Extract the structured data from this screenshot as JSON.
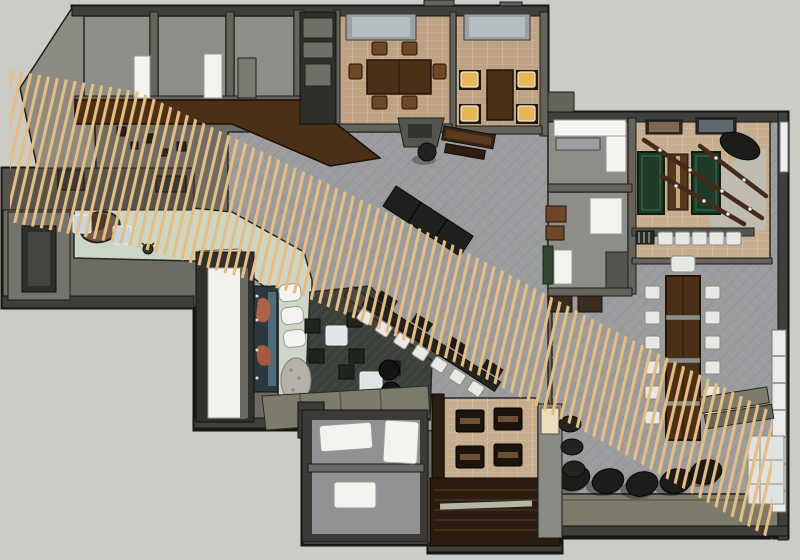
{
  "scene": {
    "type": "architectural-3d-floor-plan-render",
    "style": "sketchup-overhead-view",
    "subject": "restaurant-bar interior plan with diagonal wood slat screen"
  },
  "palette": {
    "canvas": "#cbccc6",
    "wall_face": "#6c6b64",
    "wall_dark": "#403f3b",
    "facade_gray": "#8b8a83",
    "floor_tile": "#9b9c9e",
    "floor_brick": "#bfa284",
    "floor_brick_light": "#c7ad8e",
    "floor_mint": "#ccd6c5",
    "floor_lounge": "#3b403a",
    "floor_white": "#f1f1ed",
    "floor_room": "#8e8e88",
    "floor_restroom": "#909193",
    "slat": "#e9bd7f",
    "wood_dark": "#4b3018",
    "wood_mid": "#6e4826",
    "wood_stair": "#2a1c0f",
    "pool_green": "#1e3b28",
    "seat_amber": "#e8b557",
    "seat_white": "#e8e8e4",
    "cube": "#20261f",
    "white_fixture": "#f3f3ef",
    "black": "#1c1c1a",
    "olive": "#7d7c6b",
    "skylight": "#b6bdc1",
    "lightblue": "#c5d4e2",
    "mural_orange": "#b06244",
    "mural_blue": "#6f98a8"
  },
  "rooms": [
    {
      "id": "dining-room",
      "floor": "brick",
      "tables": 1,
      "chairs": 6,
      "skylights": 1
    },
    {
      "id": "private-dining-room",
      "floor": "brick",
      "lit_amber_seats": 4,
      "skylights": 1
    },
    {
      "id": "billiards-room",
      "floor": "brick",
      "pool_tables": 2,
      "shuffleboard": 1,
      "bar_stools": 5,
      "wall_art": 2,
      "light_beams": 3
    },
    {
      "id": "main-hall",
      "floor": "gray-tile",
      "black_bench": 1,
      "round-table": 1
    },
    {
      "id": "communal-table-area",
      "chairs": 13,
      "table_sections": 4
    },
    {
      "id": "high-top-bar",
      "white_stools": 7
    },
    {
      "id": "lounge",
      "floor": "dark",
      "cube_seats": 8,
      "poufs": 2,
      "coffee_tables": 2,
      "mural": 1,
      "rock_feature": 1
    },
    {
      "id": "reception",
      "floor": "mint",
      "desk": 1,
      "side_tables": 2
    },
    {
      "id": "vestibule",
      "floor": "white"
    },
    {
      "id": "restrooms",
      "fixtures": 3
    },
    {
      "id": "booth-area",
      "booths": 4
    },
    {
      "id": "stairwell",
      "steps": 5
    },
    {
      "id": "terrace-edge",
      "barrel_stools": 5,
      "barrels": 3
    }
  ],
  "slat_screen": {
    "description": "diagonal band of tan wood slats crossing plan from upper-left to lower-right",
    "angle_deg": 30
  }
}
